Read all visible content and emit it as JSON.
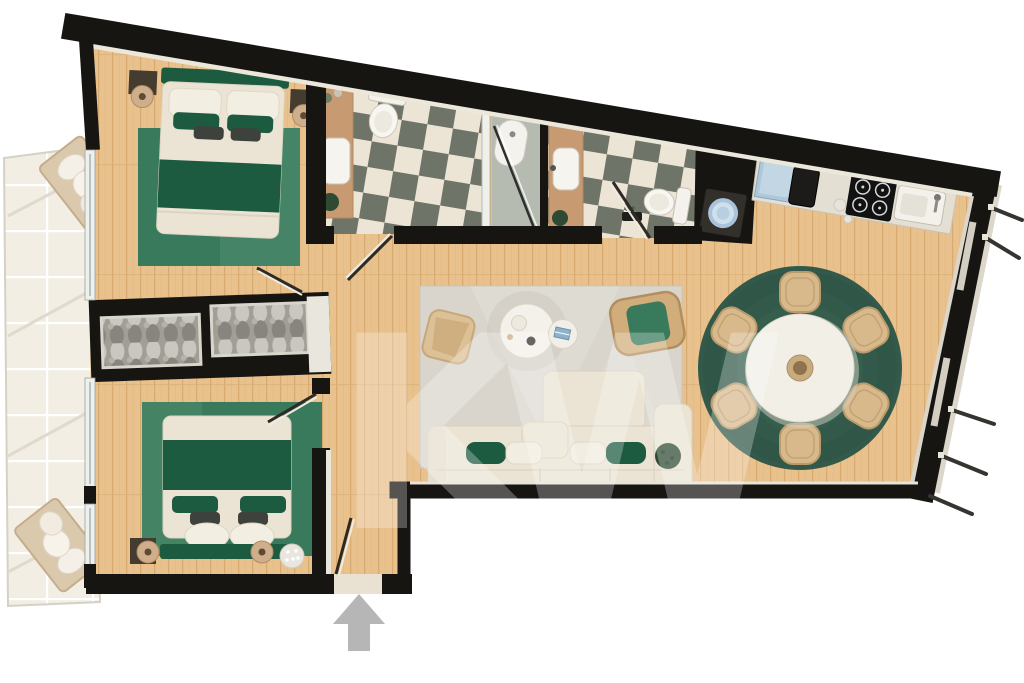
{
  "meta": {
    "kind": "apartment-floor-plan-render",
    "view": "top-down"
  },
  "watermark": {
    "text": "KW"
  },
  "colors": {
    "wall": "#161512",
    "wood_floor": "#e8c18c",
    "wood_stripe": "#d7aa72",
    "balcony_floor": "#f2eee3",
    "checker_light": "#ece5d5",
    "checker_dark": "#6f7468",
    "rug_green": "#3a7a5c",
    "dining_rug": "#33594a",
    "living_rug": "#d9d5cc",
    "bedding_green": "#1d5b40",
    "cream": "#ebe4d4",
    "rattan": "#d6b587",
    "counter": "#e4dfd3",
    "arrow_grey": "#b6b6b6",
    "washer_door": "#a8c3da",
    "plant_green": "#2f4a33",
    "lamp_tan": "#cfae8b",
    "vanity_wood": "#c79a72",
    "shower_tile": "#b5bbb0",
    "glass_frame": "#eef0ec"
  },
  "legend": {
    "rooms": [
      {
        "id": "bedroom-top-left",
        "items": [
          "double-bed",
          "green-area-rug",
          "nightstands",
          "round-table-lamps"
        ]
      },
      {
        "id": "bedroom-bottom-left",
        "items": [
          "double-bed",
          "green-area-rug",
          "round-table-lamps",
          "flower-bouquet"
        ]
      },
      {
        "id": "wardrobe-hall",
        "items": [
          "built-in-wardrobe-left",
          "built-in-wardrobe-right"
        ]
      },
      {
        "id": "bathroom-1",
        "items": [
          "toilet",
          "wood-vanity-with-sink",
          "walk-in-shower",
          "checkerboard-tile-floor"
        ]
      },
      {
        "id": "bathroom-2",
        "items": [
          "toilet",
          "wood-vanity-with-sink",
          "checkerboard-tile-floor"
        ]
      },
      {
        "id": "laundry-nook",
        "items": [
          "washing-machine"
        ]
      },
      {
        "id": "kitchen",
        "items": [
          "counter-run",
          "black-sink",
          "four-burner-cooktop",
          "white-sink",
          "appliance"
        ]
      },
      {
        "id": "living-room",
        "items": [
          "modular-cream-sofa",
          "green-and-white-pillows",
          "round-coffee-table",
          "round-side-table",
          "rattan-accent-chair",
          "rattan-armchair-green-cushion",
          "light-grey-rug",
          "potted-plant"
        ]
      },
      {
        "id": "dining-area",
        "items": [
          "round-white-table",
          "six-rattan-chairs",
          "round-green-rug",
          "centerpiece-bowl"
        ]
      },
      {
        "id": "balcony",
        "items": [
          "lounge-chair-top",
          "lounge-chair-bottom",
          "tile-floor",
          "railing"
        ]
      },
      {
        "id": "entrance",
        "items": [
          "entry-door-open",
          "grey-up-arrow"
        ]
      }
    ]
  }
}
